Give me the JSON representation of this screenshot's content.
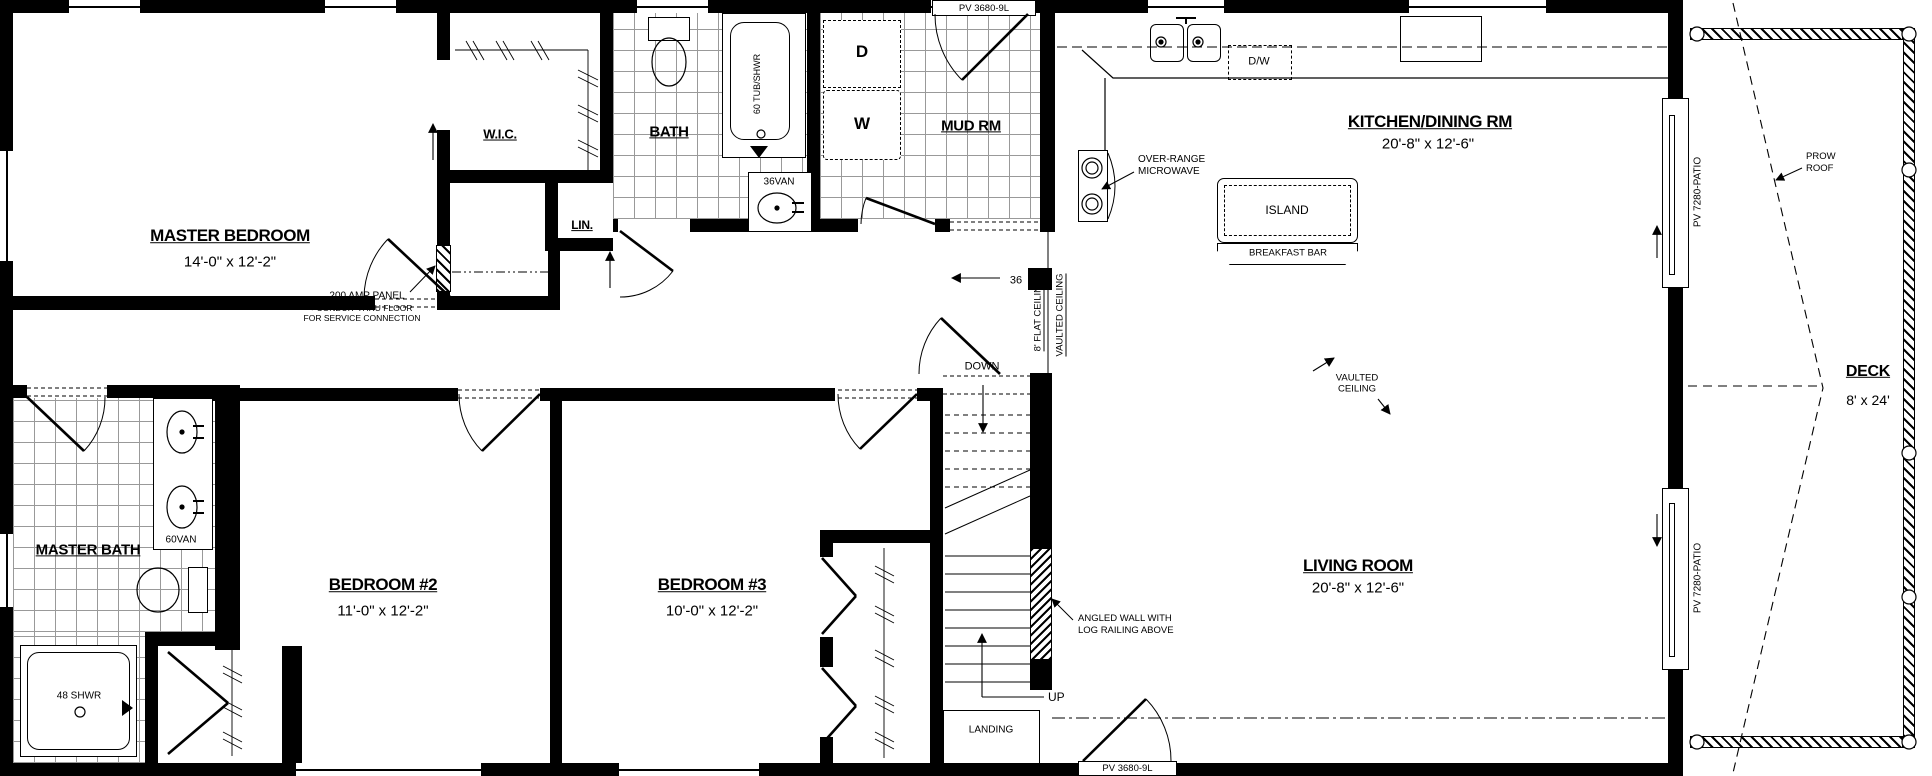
{
  "labels": {
    "master_bedroom": "MASTER BEDROOM",
    "master_bedroom_dims": "14'-0\" x 12'-2\"",
    "wic": "W.I.C.",
    "lin": "LIN.",
    "panel": "200 AMP PANEL",
    "panel_note1": ">CONDUIT THRU FLOOR",
    "panel_note2": "FOR SERVICE CONNECTION",
    "bath": "BATH",
    "tub": "60 TUB/SHWR",
    "van36": "36VAN",
    "dryer": "D",
    "washer": "W",
    "mud_rm": "MUD RM",
    "pv_window_top": "PV 3680-9L",
    "kitchen": "KITCHEN/DINING RM",
    "kitchen_dims": "20'-8\" x 12'-6\"",
    "dw": "D/W",
    "otr1": "OVER-RANGE",
    "otr2": "MICROWAVE",
    "island": "ISLAND",
    "breakfast_bar": "BREAKFAST BAR",
    "door36": "36",
    "flat_ceiling": "8' FLAT CEILING",
    "vaulted_break": "VAULTED CEILING",
    "vaulted1": "VAULTED",
    "vaulted2": "CEILING",
    "living": "LIVING ROOM",
    "living_dims": "20'-8\" x 12'-6\"",
    "down": "DOWN",
    "up": "UP",
    "landing": "LANDING",
    "angled1": "ANGLED WALL WITH",
    "angled2": "LOG RAILING ABOVE",
    "master_bath": "MASTER BATH",
    "van60": "60VAN",
    "shwr48": "48 SHWR",
    "bedroom2": "BEDROOM #2",
    "bedroom2_dims": "11'-0\" x 12'-2\"",
    "bedroom3": "BEDROOM #3",
    "bedroom3_dims": "10'-0\" x 12'-2\"",
    "deck": "DECK",
    "deck_dims": "8' x 24'",
    "prow1": "PROW",
    "prow2": "ROOF",
    "patio_door_top": "PV 7280-PATIO",
    "patio_door_bottom": "PV 7280-PATIO",
    "pv_door_bottom": "PV 3680-9L"
  }
}
